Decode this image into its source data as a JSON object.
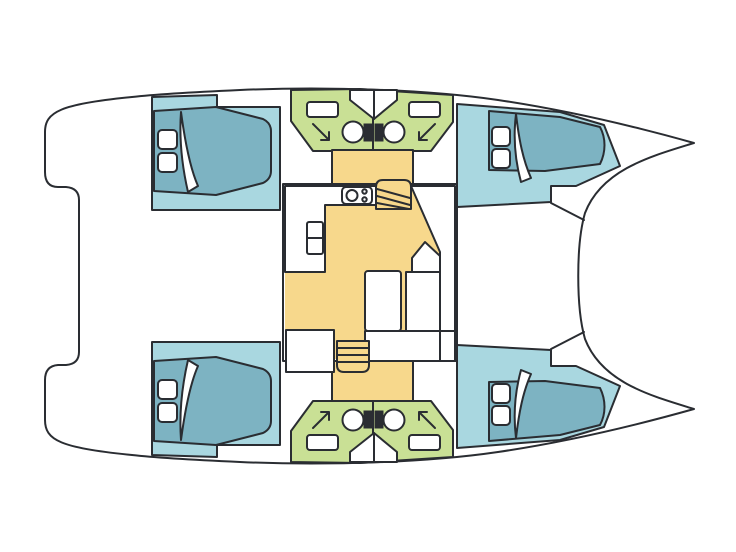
{
  "meta": {
    "title": "Catamaran yacht interior layout - top view floor plan",
    "orientation": "bow-right",
    "symmetry": "port and starboard hulls mirrored"
  },
  "palette": {
    "background": "#ffffff",
    "outline": "#2a2d32",
    "deck": "#ffffff",
    "cabin_floor": "#a9d7e0",
    "berth": "#7db3c2",
    "bathroom": "#c9e095",
    "living_floor": "#f7d88c",
    "fixture_white": "#ffffff"
  },
  "layout_summary": {
    "hulls": 2,
    "double_cabins": 4,
    "bathrooms": 4,
    "toilets": 4,
    "showers": 4,
    "vanities": 4,
    "deck_hatches": 8,
    "saloon": 1,
    "stairways_to_hulls": 2
  },
  "rooms": {
    "port_hull": [
      "aft double cabin",
      "aft bathroom",
      "forward bathroom",
      "forward double cabin"
    ],
    "starboard_hull": [
      "aft double cabin",
      "aft bathroom",
      "forward bathroom",
      "forward double cabin"
    ],
    "saloon_features": [
      "L-shaped galley counter",
      "two-burner stove",
      "refrigerator",
      "dining table",
      "L-shaped settee",
      "forward seat",
      "stairs to port hull",
      "stairs to starboard hull"
    ]
  }
}
